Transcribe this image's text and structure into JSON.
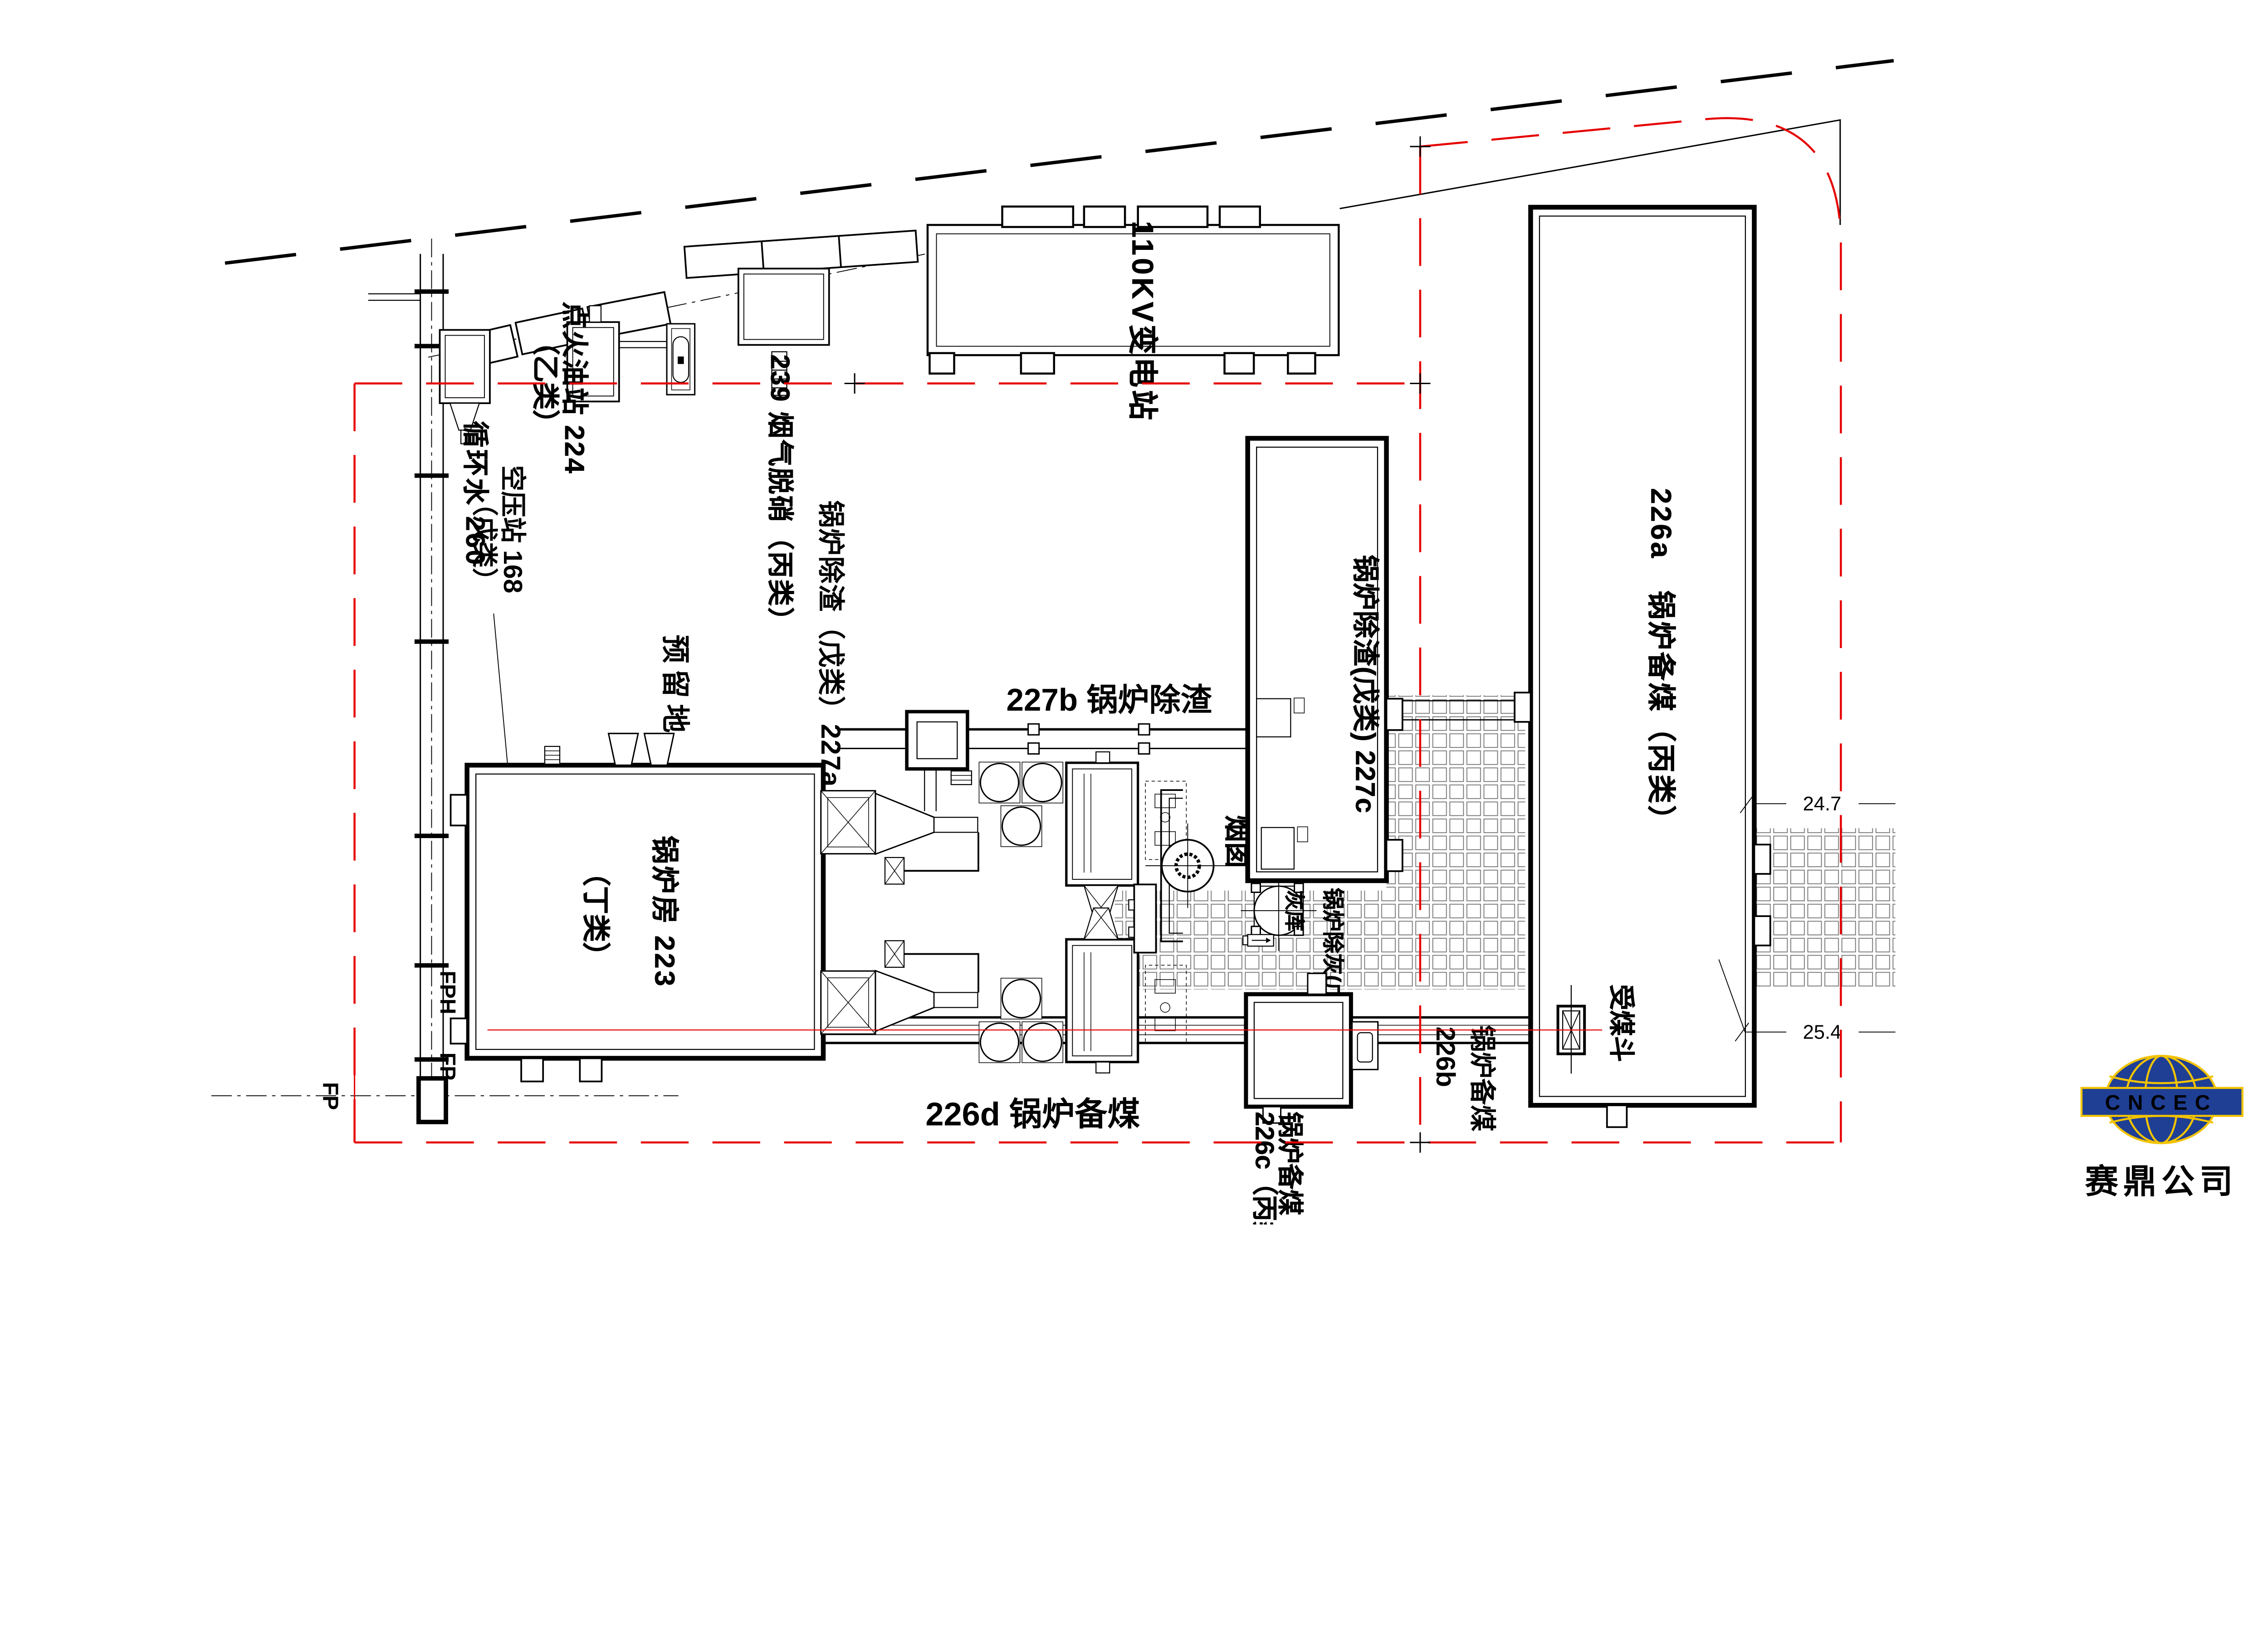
{
  "drawing": {
    "type": "plant-site-plan",
    "colors": {
      "boundary_red": "#e60000",
      "line_black": "#000000",
      "hatch_gray": "#777777",
      "logo_blue": "#1f3f94",
      "logo_yellow": "#f2c300",
      "logo_text": "#111111"
    },
    "labels": {
      "circulating_water": "循环水 260",
      "ignition_oil_station": "点火油站 224",
      "ignition_oil_class": "（乙类）",
      "denitration": "239 烟气脱硝（丙类）",
      "substation_110kv": "110KV变电站",
      "air_compressor": "空压站 168",
      "air_compressor_class": "（戊类）",
      "reserved_land": "预留地",
      "slag_227a": "锅炉除渣（戊类）227a",
      "slag_227b": "227b 锅炉除渣",
      "slag_227c": "锅炉除渣(戊类) 227c",
      "boiler_house": "锅炉房 223",
      "boiler_house_class": "（丁类）",
      "chimney": "烟囱",
      "ash_silo": "灰库",
      "ash_removal": "锅炉除灰(戊类)",
      "coal_226a": "226a　锅炉备煤（丙类）",
      "coal_226b_name": "锅炉备煤",
      "coal_226b_no": "226b",
      "coal_226c_name": "锅炉备煤",
      "coal_226c_no": "226c（丙类）",
      "coal_226d": "226d 锅炉备煤",
      "coal_hopper": "受煤斗",
      "rack_fph": "FPH",
      "rack_fp": "FP",
      "left_fp": "FP"
    },
    "dimensions": {
      "dim_24_7": "24.7",
      "dim_25_4": "25.4"
    },
    "logo": {
      "acronym": "CNCEC",
      "company": "赛鼎公司"
    }
  }
}
